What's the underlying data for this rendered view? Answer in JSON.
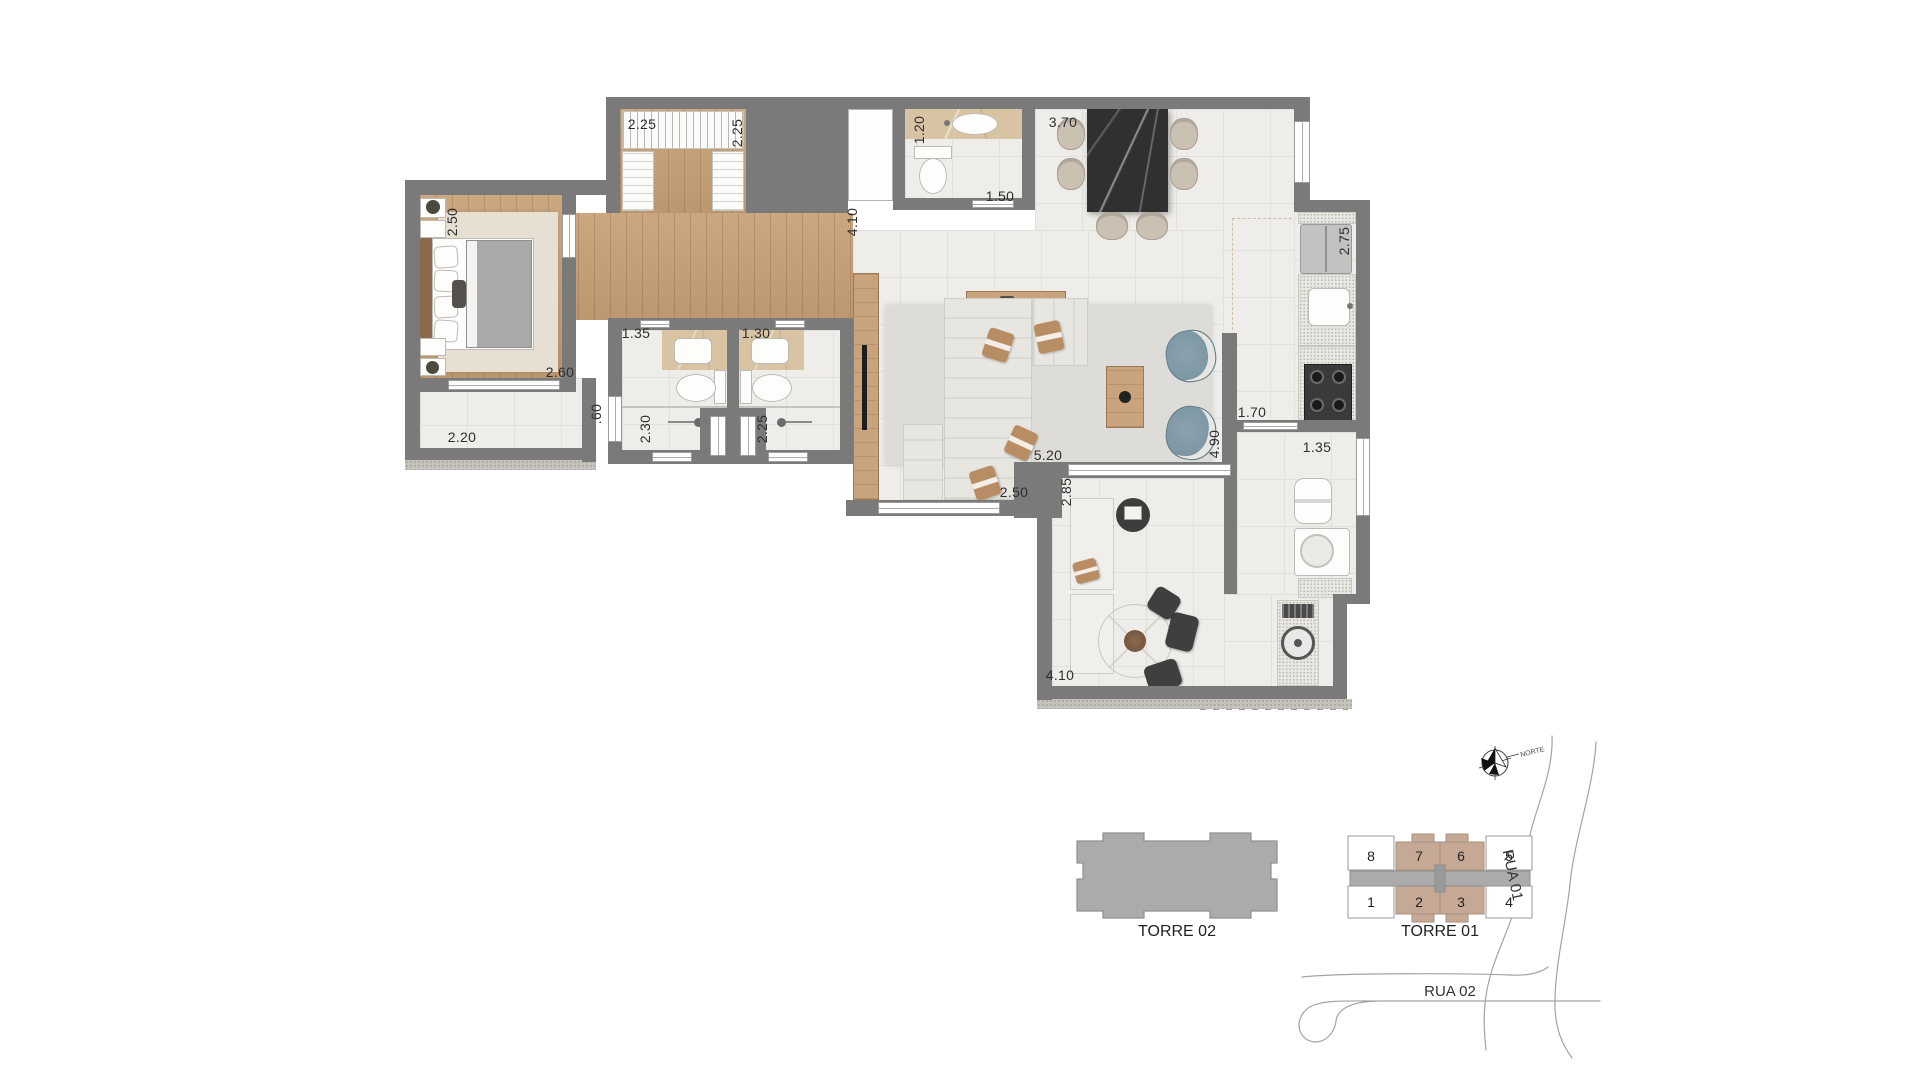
{
  "colors": {
    "wall": "#7a7a7a",
    "tile": "#eeede9",
    "wood": "#c7a076",
    "rug": "#d9d8d4",
    "marble": "#d8c3a3",
    "dining_table": "#303030",
    "accent_chair": "#7e95a1",
    "unit_tan": "#c5a994",
    "tower_gray": "#ababab"
  },
  "floorplan": {
    "dimensions": [
      {
        "id": "closet-width",
        "text": "2.25",
        "orientation": "horizontal"
      },
      {
        "id": "closet-depth",
        "text": "2.25",
        "orientation": "vertical"
      },
      {
        "id": "lavabo-width",
        "text": "1.20",
        "orientation": "vertical"
      },
      {
        "id": "lavabo-door",
        "text": "1.50",
        "orientation": "horizontal"
      },
      {
        "id": "dining-width",
        "text": "3.70",
        "orientation": "horizontal"
      },
      {
        "id": "kitchen-depth",
        "text": "2.75",
        "orientation": "vertical"
      },
      {
        "id": "hall-length",
        "text": "4.10",
        "orientation": "vertical"
      },
      {
        "id": "bedroom-depth",
        "text": "2.50",
        "orientation": "vertical"
      },
      {
        "id": "bedroom-width",
        "text": "2.60",
        "orientation": "horizontal"
      },
      {
        "id": "bedroom-balcony-width",
        "text": "2.20",
        "orientation": "horizontal"
      },
      {
        "id": "ledge-width",
        "text": ".60",
        "orientation": "vertical"
      },
      {
        "id": "bath1-depth",
        "text": "2.30",
        "orientation": "vertical"
      },
      {
        "id": "bath1-width",
        "text": "1.35",
        "orientation": "horizontal"
      },
      {
        "id": "bath2-width",
        "text": "1.30",
        "orientation": "horizontal"
      },
      {
        "id": "bath2-depth",
        "text": "2.25",
        "orientation": "vertical"
      },
      {
        "id": "living-length",
        "text": "5.20",
        "orientation": "horizontal"
      },
      {
        "id": "living-window",
        "text": "2.50",
        "orientation": "horizontal"
      },
      {
        "id": "living-depth",
        "text": "4.90",
        "orientation": "vertical"
      },
      {
        "id": "service-door",
        "text": "1.70",
        "orientation": "horizontal"
      },
      {
        "id": "service-window",
        "text": "1.35",
        "orientation": "horizontal"
      },
      {
        "id": "terrace-depth",
        "text": "2.85",
        "orientation": "vertical"
      },
      {
        "id": "terrace-width",
        "text": "4.10",
        "orientation": "horizontal"
      }
    ]
  },
  "site": {
    "torre02_label": "TORRE 02",
    "torre01_label": "TORRE 01",
    "norte_label": "NORTE",
    "rua01_label": "RUA 01",
    "rua02_label": "RUA 02",
    "units": [
      "8",
      "7",
      "6",
      "5",
      "1",
      "2",
      "3",
      "4"
    ],
    "highlighted_units": [
      "7",
      "6",
      "2",
      "3"
    ]
  }
}
